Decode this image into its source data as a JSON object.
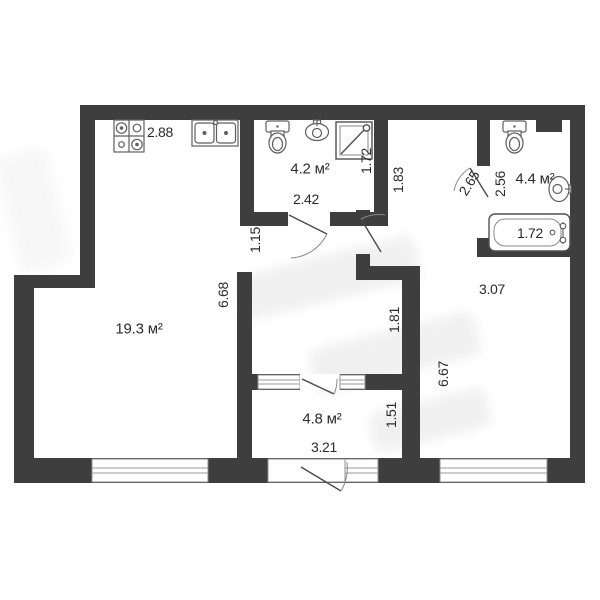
{
  "title": "apartment-floor-plan",
  "colors": {
    "wall": "#3e3e3e",
    "text": "#2b2b2b",
    "fixture_stroke": "#6f6f6f",
    "background": "#ffffff"
  },
  "rooms": {
    "studio": {
      "area": "19.3 м²",
      "dims": {
        "kitchen_width": "2.88",
        "height": "6.68"
      }
    },
    "bath_small": {
      "area": "4.2 м²",
      "dims": {
        "width": "2.42",
        "depth": "1.72"
      }
    },
    "bath_large": {
      "area": "4.4 м²",
      "dims": {
        "depth": "2.56",
        "door": "2.65",
        "bathtub": "1.72"
      }
    },
    "loggia": {
      "area": "4.8 м²",
      "dims": {
        "width": "3.21",
        "depth": "1.51"
      }
    },
    "room_right": {
      "dims": {
        "width": "3.07",
        "height": "6.67"
      }
    },
    "hallway": {
      "dims": {
        "passage": "1.15",
        "entry": "1.83",
        "lower": "1.81"
      }
    }
  },
  "fixtures": [
    "stove",
    "kitchen-sink",
    "toilet",
    "washbasin",
    "shower",
    "toilet",
    "washbasin",
    "bathtub",
    "vent-shaft"
  ],
  "windows_count": 5,
  "doors_count": 5
}
